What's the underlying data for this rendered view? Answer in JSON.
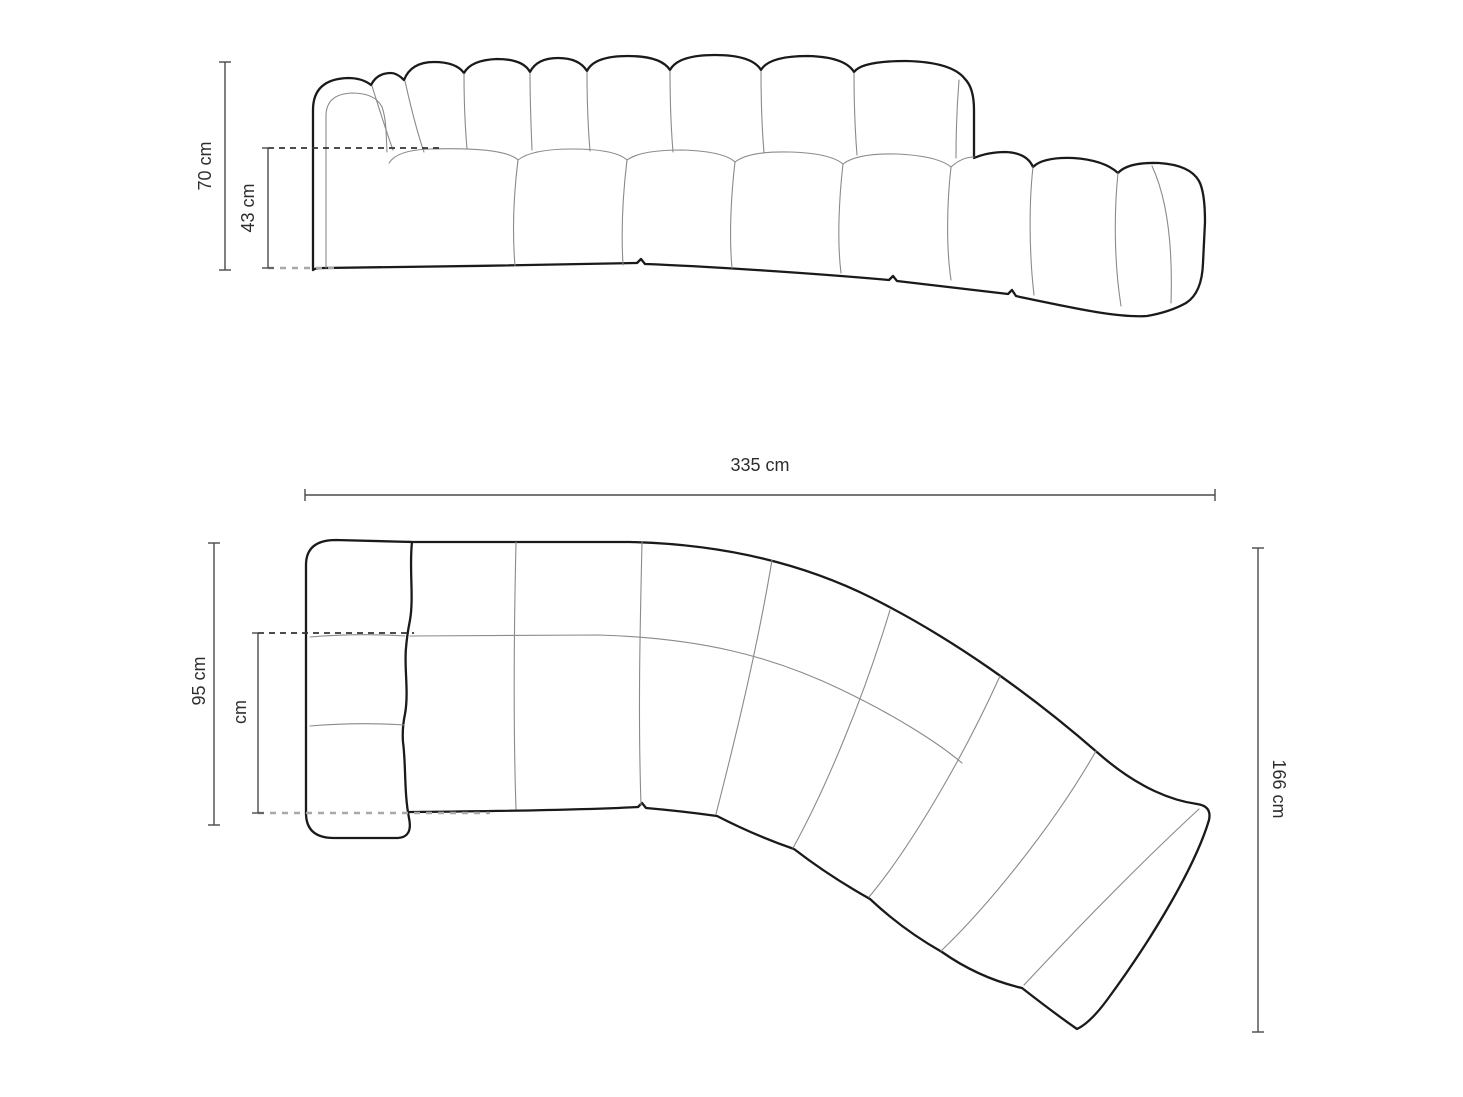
{
  "front_view": {
    "height_label": "70 cm",
    "seat_height_label": "43 cm"
  },
  "plan_view": {
    "width_label": "335 cm",
    "depth_label": "95 cm",
    "partial_depth_label": "cm",
    "total_depth_label": "166 cm"
  },
  "colors": {
    "background": "#ffffff",
    "outline": "#1a1a1a",
    "seam": "#8a8a8a",
    "dimension": "#4a4a4a",
    "dash_dark": "#333333",
    "dash_light": "#a8a8a8",
    "label": "#2e2e2e"
  }
}
